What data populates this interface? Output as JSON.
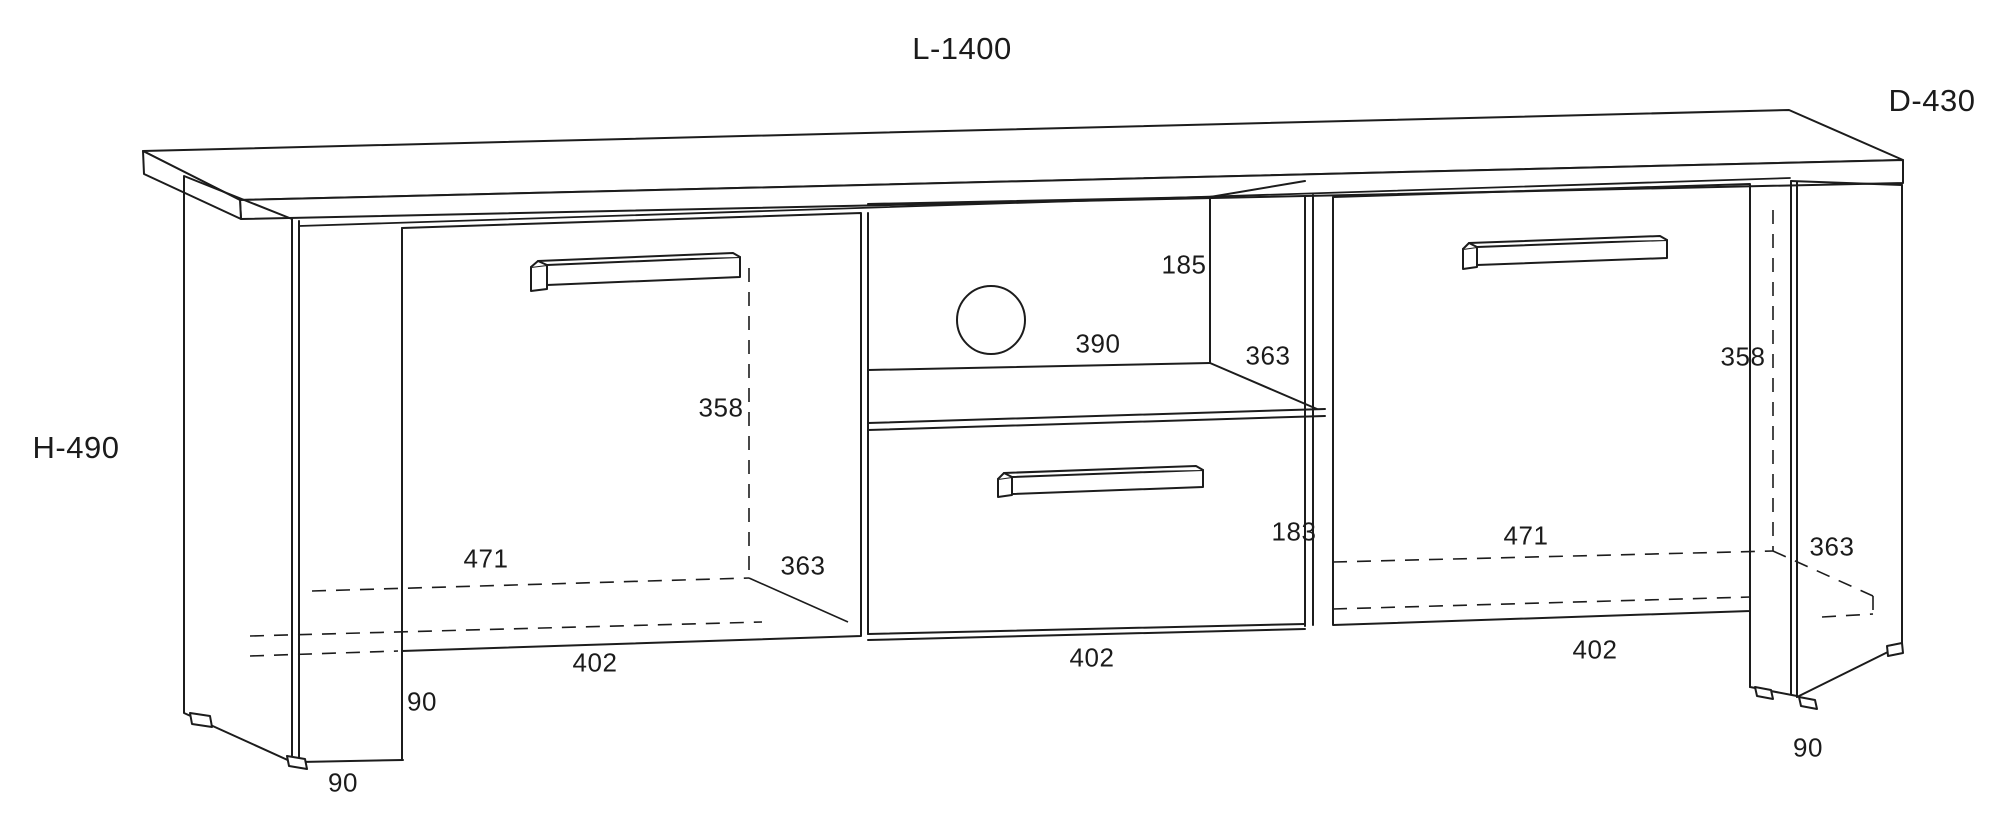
{
  "page": {
    "background_color": "#ffffff",
    "line_color": "#1c1c1c",
    "description": "Technical dimension drawing of a TV stand cabinet with two doors, open middle shelf with cable hole, and one drawer"
  },
  "furniture_diagram": {
    "overall_dimensions": {
      "length": "L-1400",
      "depth": "D-430",
      "height": "H-490"
    },
    "components": [
      "top panel",
      "left side panel with feet",
      "left door with bar handle",
      "open middle compartment with cable hole",
      "middle drawer with bar handle",
      "right door with bar handle",
      "right side panel with feet"
    ],
    "dimension_labels": [
      {
        "id": "length-total",
        "text": "L-1400",
        "x": 962,
        "y": 49,
        "size": "large"
      },
      {
        "id": "depth-total",
        "text": "D-430",
        "x": 1932,
        "y": 101,
        "size": "large"
      },
      {
        "id": "height-total",
        "text": "H-490",
        "x": 76,
        "y": 448,
        "size": "large"
      },
      {
        "id": "shelf-height",
        "text": "185",
        "x": 1184,
        "y": 265,
        "size": "normal"
      },
      {
        "id": "shelf-width",
        "text": "390",
        "x": 1098,
        "y": 344,
        "size": "normal"
      },
      {
        "id": "shelf-depth",
        "text": "363",
        "x": 1268,
        "y": 356,
        "size": "normal"
      },
      {
        "id": "left-interior-height",
        "text": "358",
        "x": 721,
        "y": 408,
        "size": "normal"
      },
      {
        "id": "right-interior-height",
        "text": "358",
        "x": 1743,
        "y": 357,
        "size": "normal"
      },
      {
        "id": "left-interior-width",
        "text": "471",
        "x": 486,
        "y": 559,
        "size": "normal"
      },
      {
        "id": "right-interior-width",
        "text": "471",
        "x": 1526,
        "y": 536,
        "size": "normal"
      },
      {
        "id": "left-interior-depth",
        "text": "363",
        "x": 803,
        "y": 566,
        "size": "normal"
      },
      {
        "id": "right-interior-depth",
        "text": "363",
        "x": 1832,
        "y": 547,
        "size": "normal"
      },
      {
        "id": "drawer-height",
        "text": "183",
        "x": 1294,
        "y": 532,
        "size": "normal"
      },
      {
        "id": "left-door-width",
        "text": "402",
        "x": 595,
        "y": 663,
        "size": "normal"
      },
      {
        "id": "middle-width",
        "text": "402",
        "x": 1092,
        "y": 658,
        "size": "normal"
      },
      {
        "id": "right-door-width",
        "text": "402",
        "x": 1595,
        "y": 650,
        "size": "normal"
      },
      {
        "id": "leg-height-left-inner",
        "text": "90",
        "x": 422,
        "y": 702,
        "size": "normal"
      },
      {
        "id": "leg-height-left-front",
        "text": "90",
        "x": 343,
        "y": 783,
        "size": "normal"
      },
      {
        "id": "leg-height-right",
        "text": "90",
        "x": 1808,
        "y": 748,
        "size": "normal"
      }
    ]
  }
}
